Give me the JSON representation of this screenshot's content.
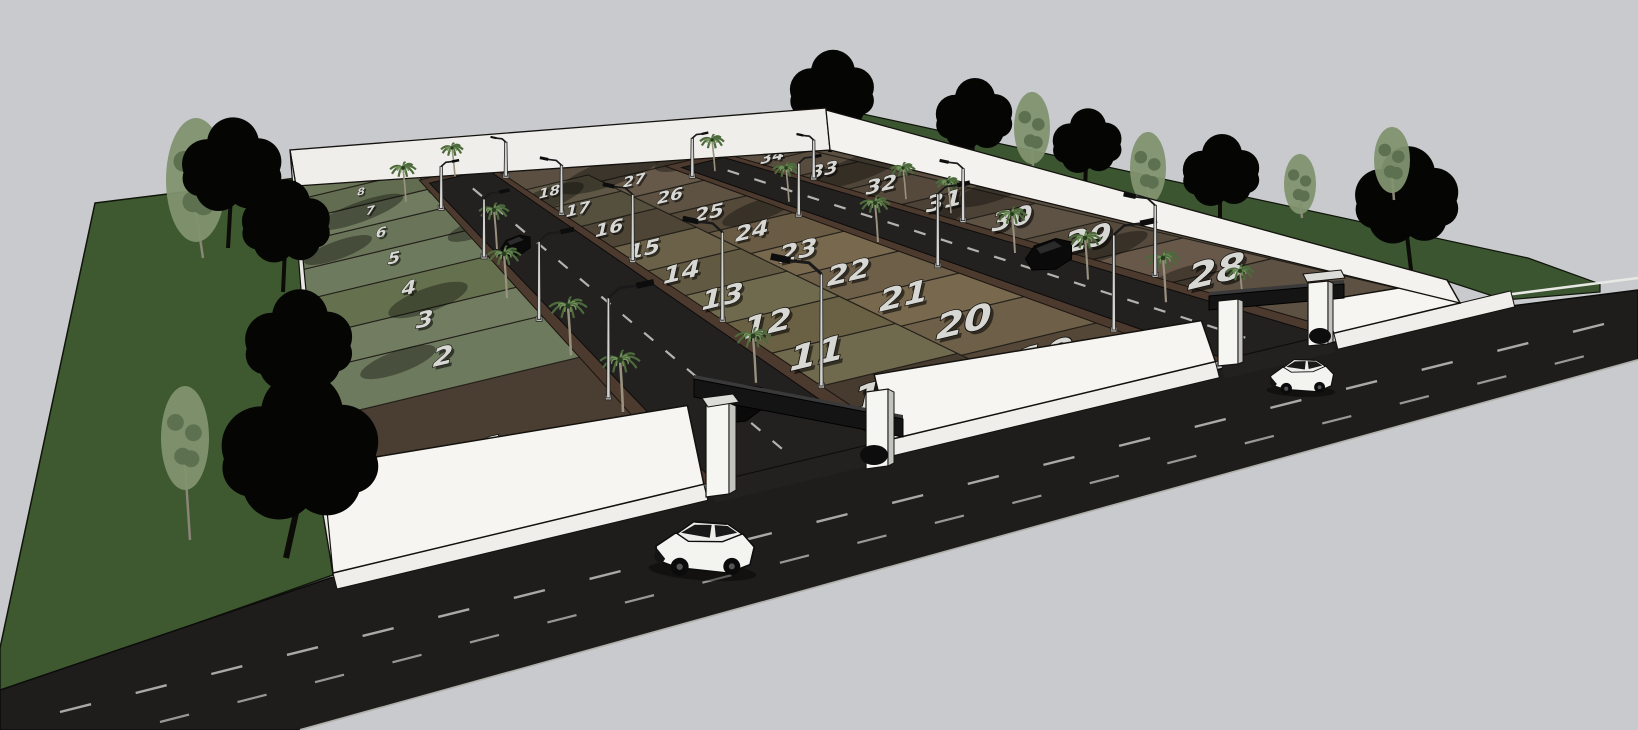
{
  "title": "3D render of a gated residential plot subdivision",
  "scene": {
    "sky_color": "#c9cacd",
    "grass_color": "#3e5830",
    "right_strip_color": "#3b5530",
    "main_road_color": "#1e1d1c",
    "inner_road_color": "#232020",
    "curb_color": "#4d3a2e",
    "sidewalk_color": "#efeeeb",
    "wall_color": "#f6f5f2",
    "back_wall_color": "#efeeea",
    "lane_dash_color": "#c2c2bf",
    "number_fill": "#d7d7d4",
    "number_stroke": "#12100c",
    "gate_beam_color": "#141414",
    "palm_frond_color": "#4c6a3c",
    "dark_tree_color": "#050504",
    "light_tree_color": "#81926f"
  },
  "site": {
    "name": "gated-plot-subdivision",
    "plot_count": 35,
    "columns": [
      {
        "id": "A",
        "plots": [
          {
            "n": "1",
            "c": "#4a3e33"
          },
          {
            "n": "2",
            "c": "#6e7a5e"
          },
          {
            "n": "3",
            "c": "#717c60"
          },
          {
            "n": "4",
            "c": "#65714e"
          },
          {
            "n": "5",
            "c": "#6e7a5e"
          },
          {
            "n": "6",
            "c": "#697459"
          },
          {
            "n": "7",
            "c": "#707b5f"
          },
          {
            "n": "8",
            "c": "#616c50"
          },
          {
            "n": "9",
            "c": "#6a7558"
          }
        ]
      },
      {
        "id": "B",
        "plots": [
          {
            "n": "10",
            "c": "#473b2f"
          },
          {
            "n": "11",
            "c": "#6f6a4e"
          },
          {
            "n": "12",
            "c": "#6a6144"
          },
          {
            "n": "13",
            "c": "#6f6a4e"
          },
          {
            "n": "14",
            "c": "#625942"
          },
          {
            "n": "15",
            "c": "#6a6148"
          },
          {
            "n": "16",
            "c": "#4e4537"
          },
          {
            "n": "17",
            "c": "#554f3e"
          },
          {
            "n": "18",
            "c": "#5e5745"
          }
        ]
      },
      {
        "id": "C",
        "plots": [
          {
            "n": "19",
            "c": "#544738"
          },
          {
            "n": "20",
            "c": "#6e5f49"
          },
          {
            "n": "21",
            "c": "#77684e"
          },
          {
            "n": "22",
            "c": "#6e5f49"
          },
          {
            "n": "23",
            "c": "#77684e"
          },
          {
            "n": "24",
            "c": "#6a5c44"
          },
          {
            "n": "25",
            "c": "#55493a"
          },
          {
            "n": "26",
            "c": "#5e5242"
          },
          {
            "n": "27",
            "c": "#66594a"
          }
        ]
      },
      {
        "id": "D",
        "plots": [
          {
            "n": "28",
            "c": "#5d5143"
          },
          {
            "n": "29",
            "c": "#68584a"
          },
          {
            "n": "30",
            "c": "#554a3c"
          },
          {
            "n": "31",
            "c": "#5e5244"
          },
          {
            "n": "32",
            "c": "#4c4236"
          },
          {
            "n": "33",
            "c": "#55493c"
          },
          {
            "n": "34",
            "c": "#4f4538"
          },
          {
            "n": "35",
            "c": "#584c3f"
          }
        ]
      }
    ]
  },
  "objects": {
    "gates": [
      {
        "name": "left-entrance-gate"
      },
      {
        "name": "right-entrance-gate"
      }
    ],
    "cars": [
      {
        "name": "white-suv-on-main-road"
      },
      {
        "name": "white-car-near-right-gate"
      },
      {
        "name": "dark-car-inside-left-gate"
      },
      {
        "name": "dark-car-on-inner-road-2"
      },
      {
        "name": "dark-car-on-inner-road-1"
      }
    ],
    "street_lamp_count": 16,
    "palm_tree_count": 16,
    "large_tree_count": 15
  }
}
